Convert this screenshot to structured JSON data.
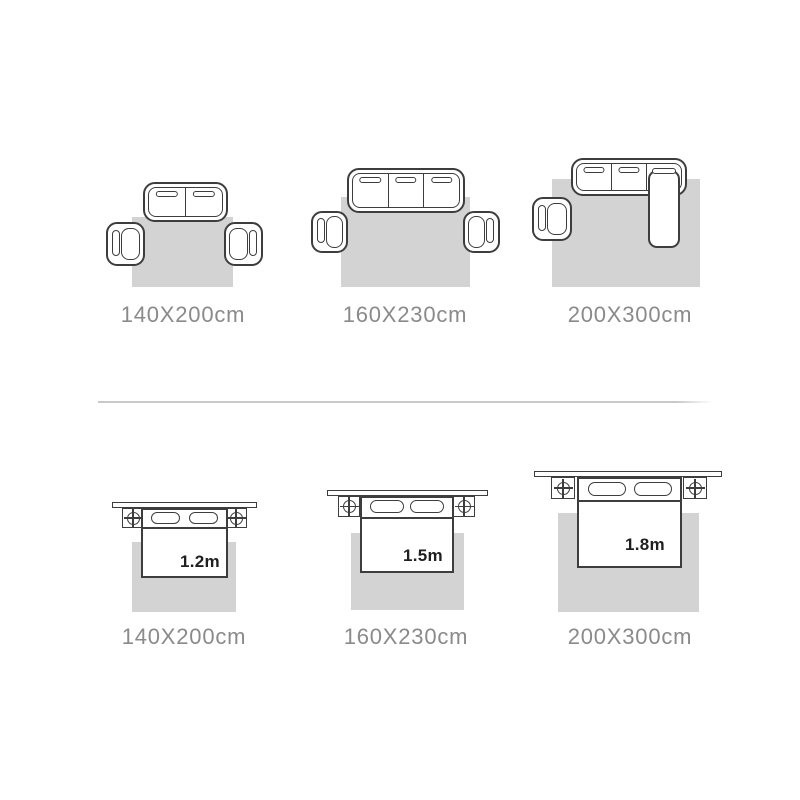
{
  "colors": {
    "outline": "#3d3d3d",
    "rug": "#d3d3d3",
    "label": "#8a8a8a",
    "bed_text": "#1f1f1f",
    "divider": "#c9c9c9"
  },
  "icons": {
    "bedside_lamp": "circle-with-cross"
  },
  "sofa_row": {
    "items": [
      {
        "size_label": "140X200cm",
        "sofa_seats": 2,
        "armchairs": 2
      },
      {
        "size_label": "160X230cm",
        "sofa_seats": 3,
        "armchairs": 2
      },
      {
        "size_label": "200X300cm",
        "sofa_seats": 3,
        "armchairs": 1,
        "has_chaise": true
      }
    ]
  },
  "bed_row": {
    "items": [
      {
        "size_label": "140X200cm",
        "bed_width": "1.2m"
      },
      {
        "size_label": "160X230cm",
        "bed_width": "1.5m"
      },
      {
        "size_label": "200X300cm",
        "bed_width": "1.8m"
      }
    ]
  }
}
